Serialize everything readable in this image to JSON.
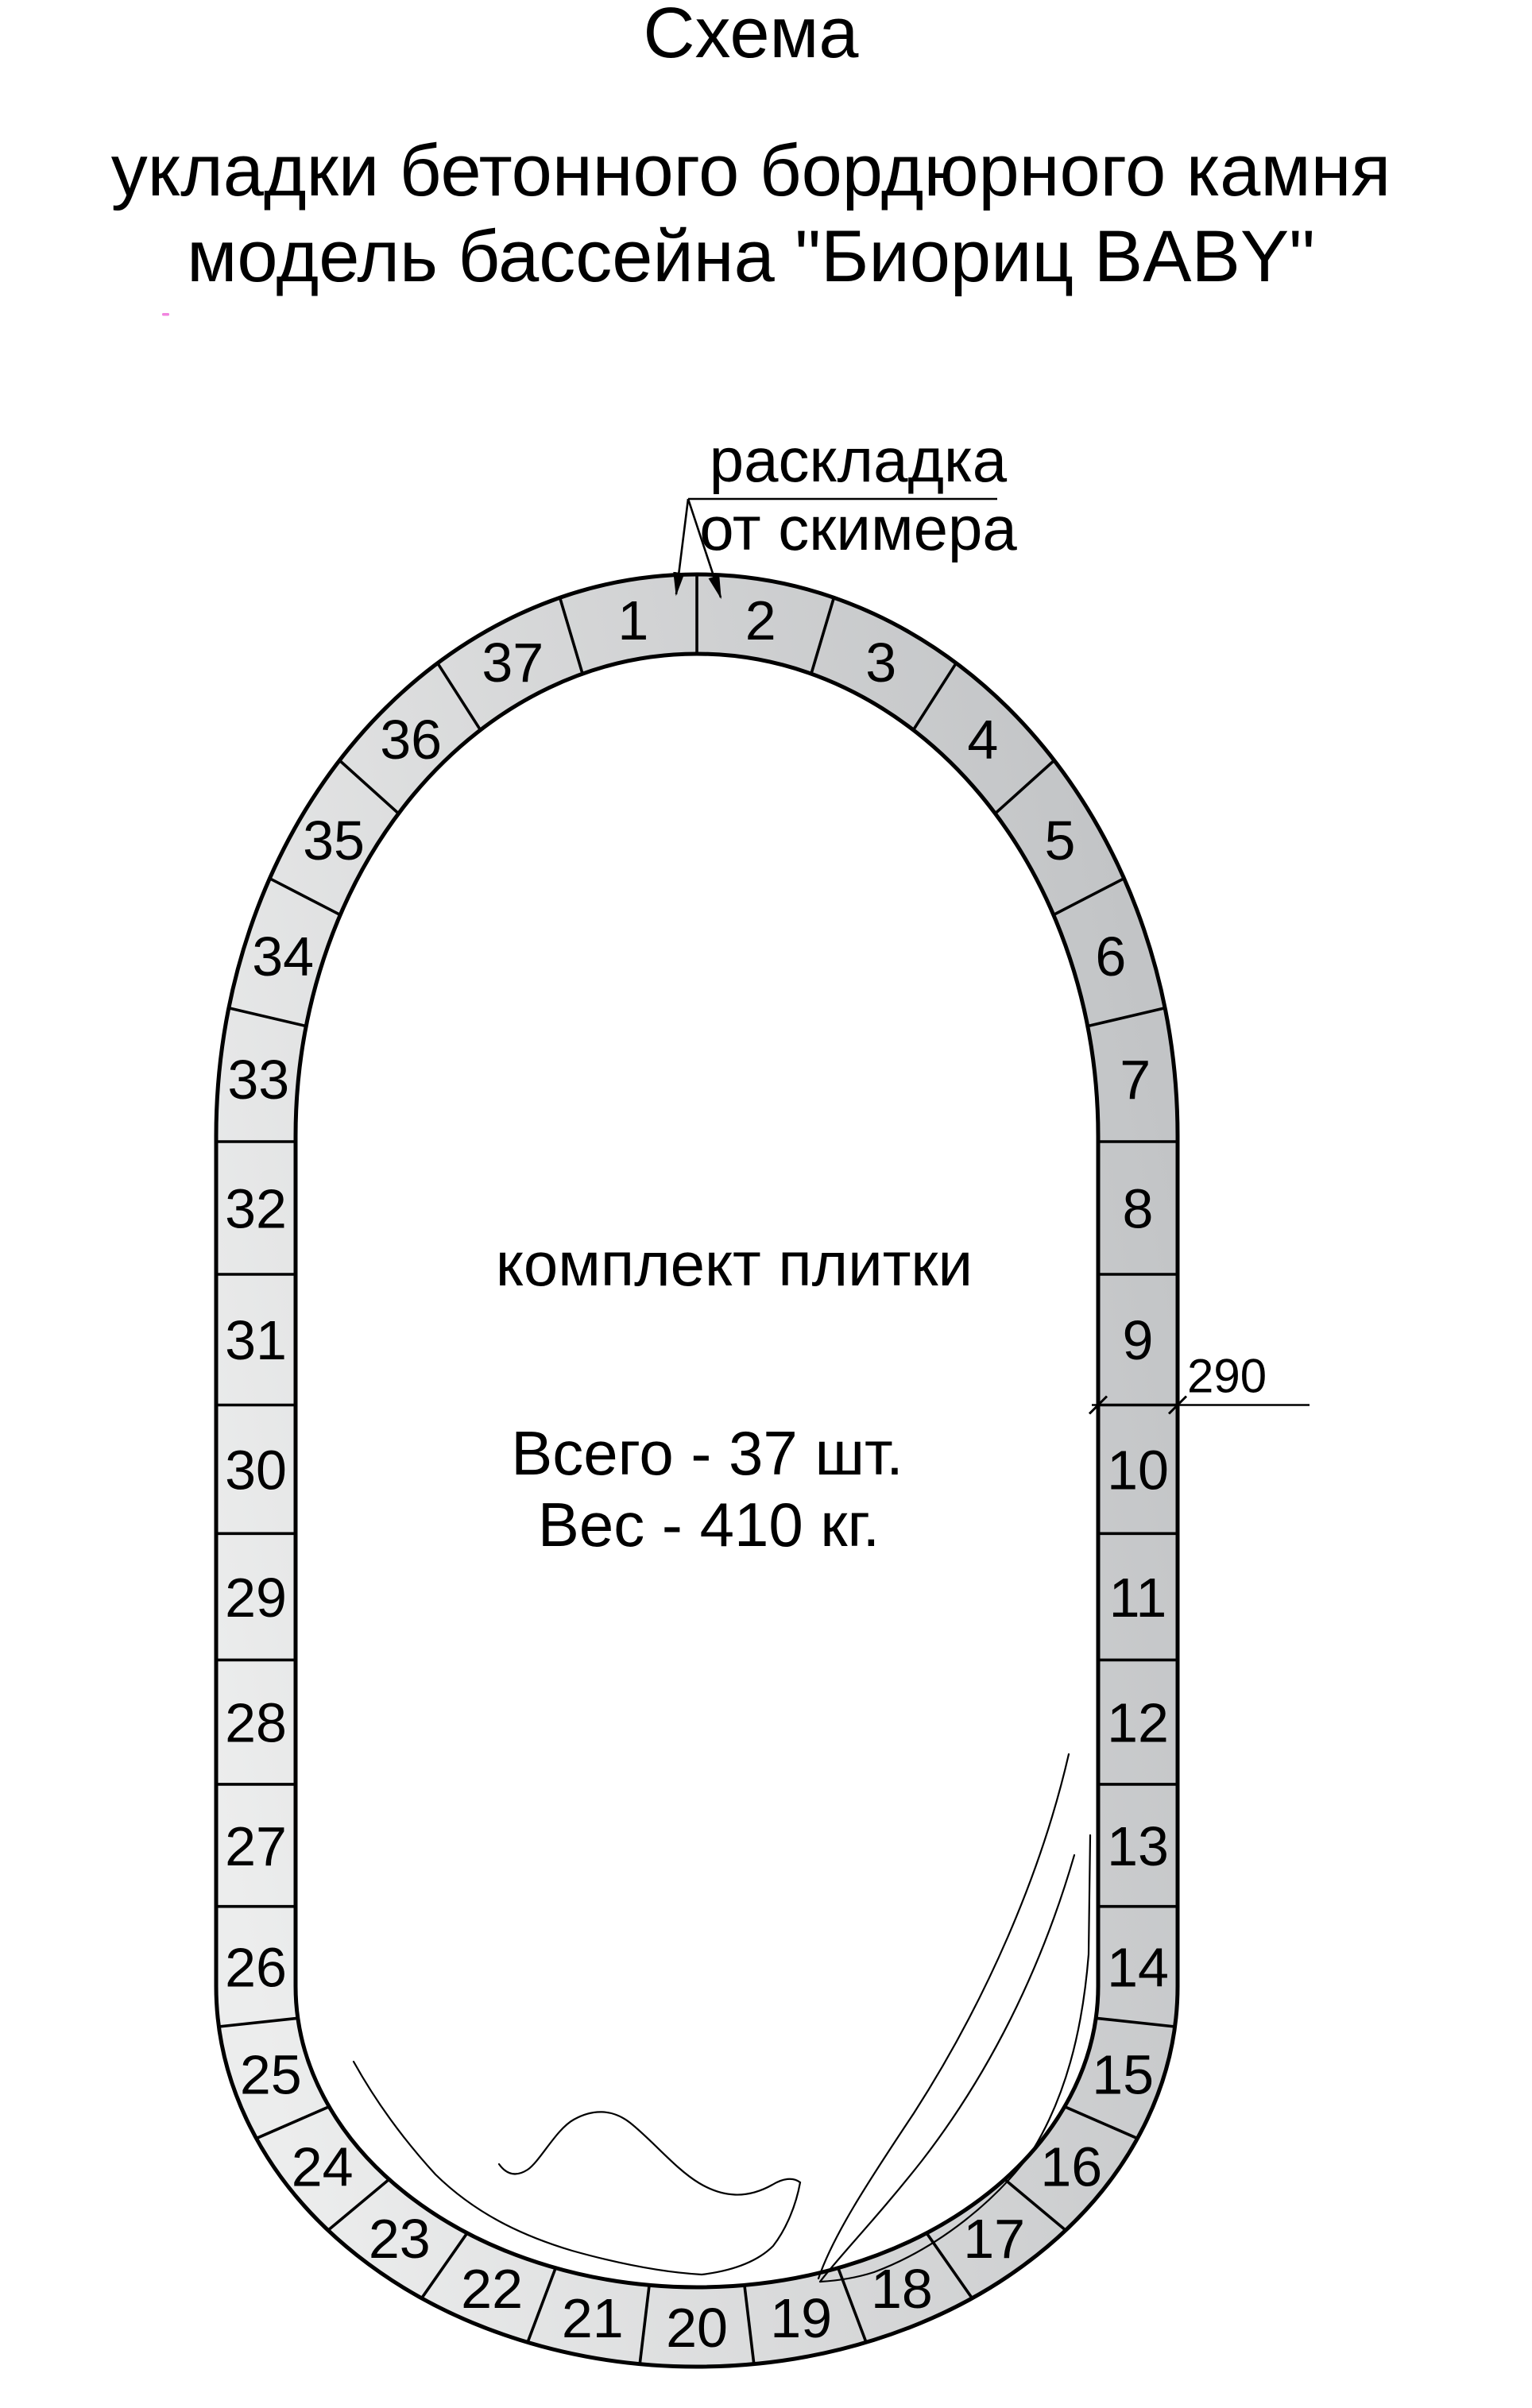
{
  "title": {
    "line1": "Схема",
    "line2": "укладки бетонного бордюрного камня",
    "line3": "модель бассейна \"Биориц BABY\""
  },
  "callout": {
    "line1": "раскладка",
    "line2": "от скимера"
  },
  "pool": {
    "center_label": "комплект плитки",
    "total": "Всего - 37 шт.",
    "weight": "Вес - 410 кг."
  },
  "dimension": {
    "depth": "290"
  },
  "tiles": {
    "count": 37,
    "numbers": [
      1,
      2,
      3,
      4,
      5,
      6,
      7,
      8,
      9,
      10,
      11,
      12,
      13,
      14,
      15,
      16,
      17,
      18,
      19,
      20,
      21,
      22,
      23,
      24,
      25,
      26,
      27,
      28,
      29,
      30,
      31,
      32,
      33,
      34,
      35,
      36,
      37
    ]
  },
  "colors": {
    "tile_dark": "#c2c4c6",
    "tile_mid": "#d6d7d8",
    "tile_light": "#eceded",
    "stroke": "#000000",
    "artifact_dot": "#ee6fd9"
  }
}
